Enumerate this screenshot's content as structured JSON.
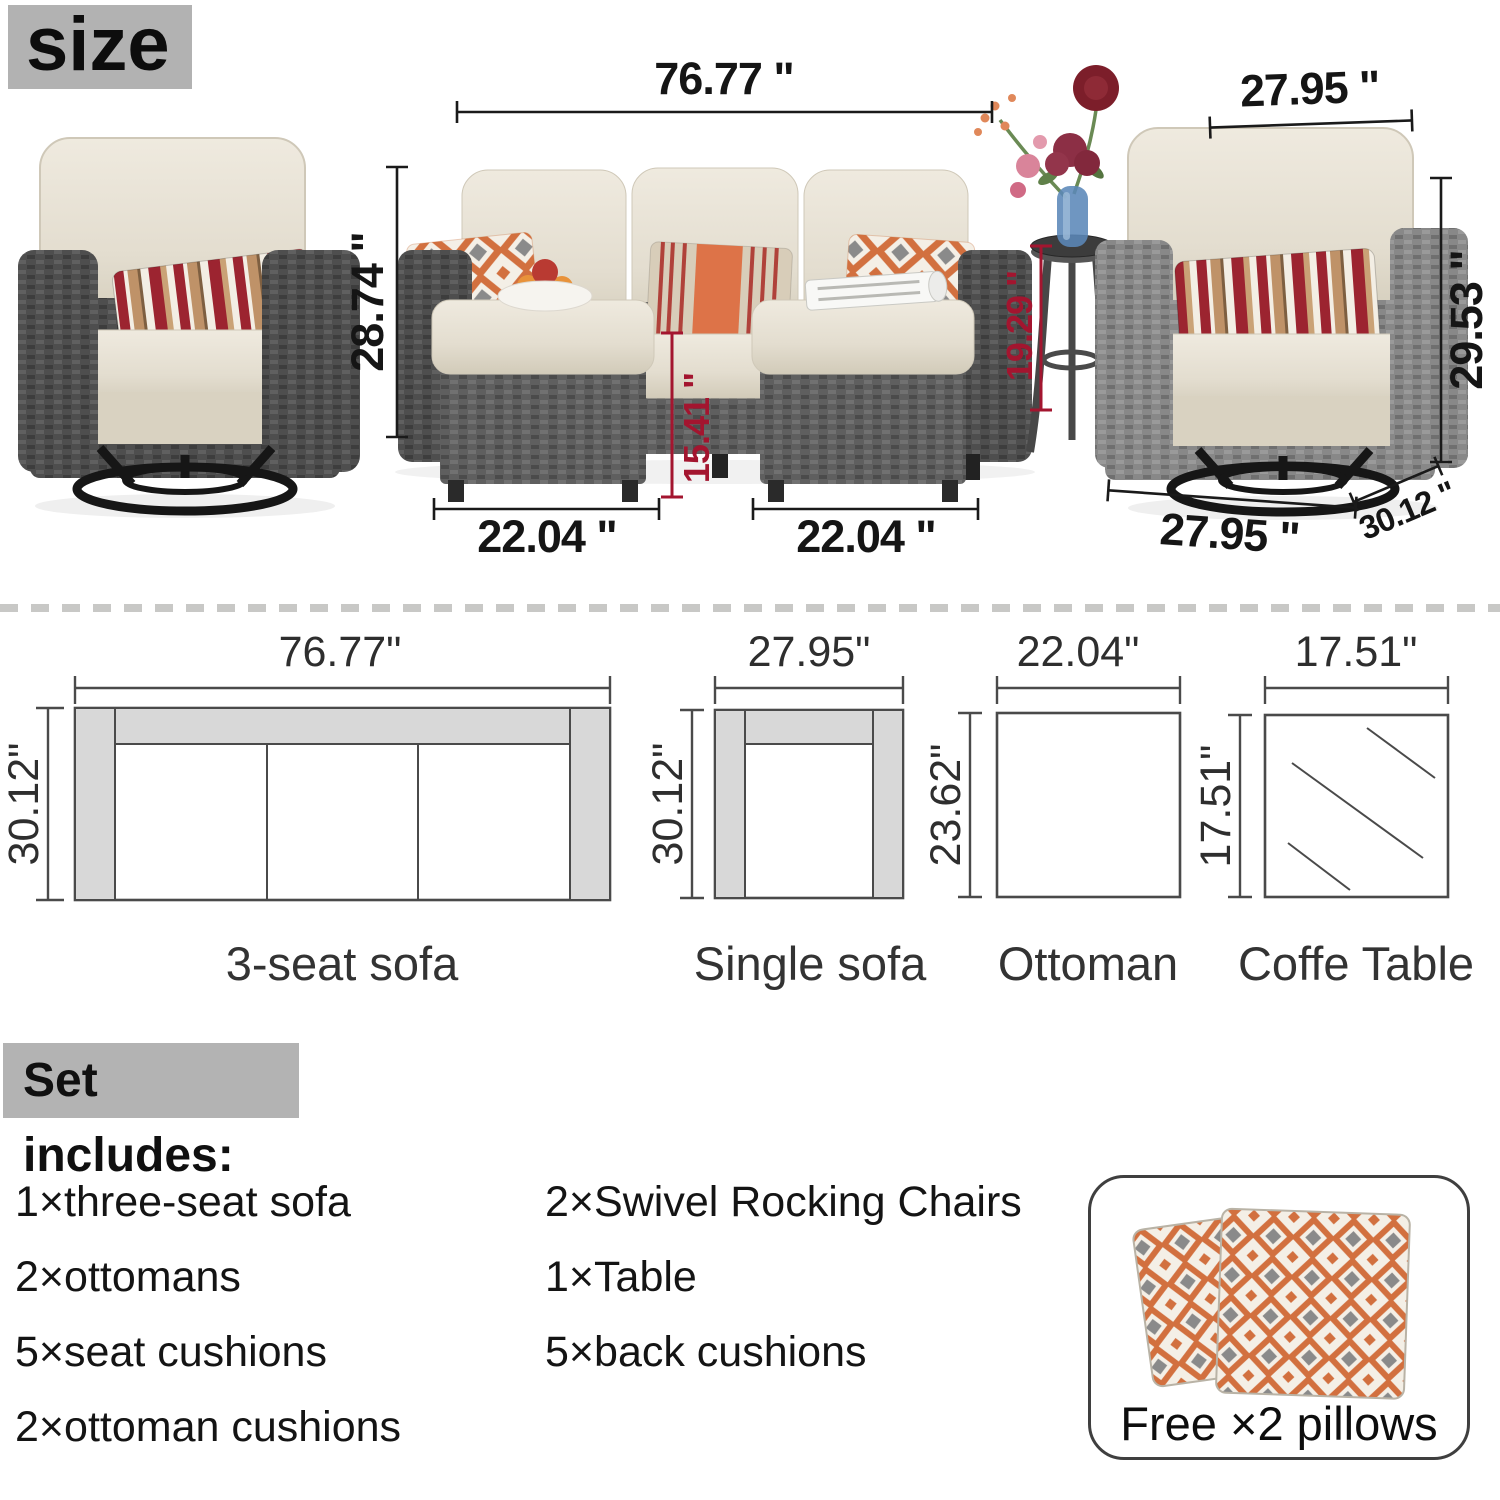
{
  "title": {
    "size_label": "size"
  },
  "photo": {
    "dims": {
      "sofa_width": "76.77 \"",
      "chair_top_width": "27.95 \"",
      "chair_left_height": "28.74 \"",
      "chair_right_height": "29.53 \"",
      "table_height": "19.29 \"",
      "ottoman_height": "15.41 \"",
      "ottoman_left_width": "22.04 \"",
      "ottoman_right_width": "22.04 \"",
      "chair_bottom_width": "27.95 \"",
      "chair_depth": "30.12 \""
    }
  },
  "diagrams": {
    "sofa3": {
      "width": "76.77\"",
      "height": "30.12\"",
      "label": "3-seat sofa"
    },
    "single": {
      "width": "27.95\"",
      "height": "30.12\"",
      "label": "Single sofa"
    },
    "ottoman": {
      "width": "22.04\"",
      "height": "23.62\"",
      "label": "Ottoman"
    },
    "table": {
      "width": "17.51\"",
      "height": "17.51\"",
      "label": "Coffe Table"
    }
  },
  "set_includes": {
    "heading": "Set includes:",
    "col1": [
      "1×three-seat sofa",
      "2×ottomans",
      "5×seat cushions",
      "2×ottoman cushions"
    ],
    "col2": [
      "2×Swivel Rocking Chairs",
      "1×Table",
      "5×back cushions"
    ]
  },
  "free_pillows": {
    "label": "Free ×2 pillows"
  },
  "colors": {
    "dim_black": "#1a1a1a",
    "dim_red": "#a3152f",
    "heading_gray": "#b3b3b3",
    "diagram_fill_gray": "#d8d8d8",
    "diagram_line": "#4a4a4a",
    "divider_gray": "#c8c8c6",
    "wicker_dark": "#4e4e4e",
    "wicker_mid": "#5f5f5f",
    "wicker_light": "#868686",
    "cushion_beige": "#e7e1d3",
    "pillow_orange": "#d2703f",
    "pillow_red": "#9c2430",
    "pillow_tan": "#bf9268",
    "vase_blue": "#5b87b8"
  }
}
